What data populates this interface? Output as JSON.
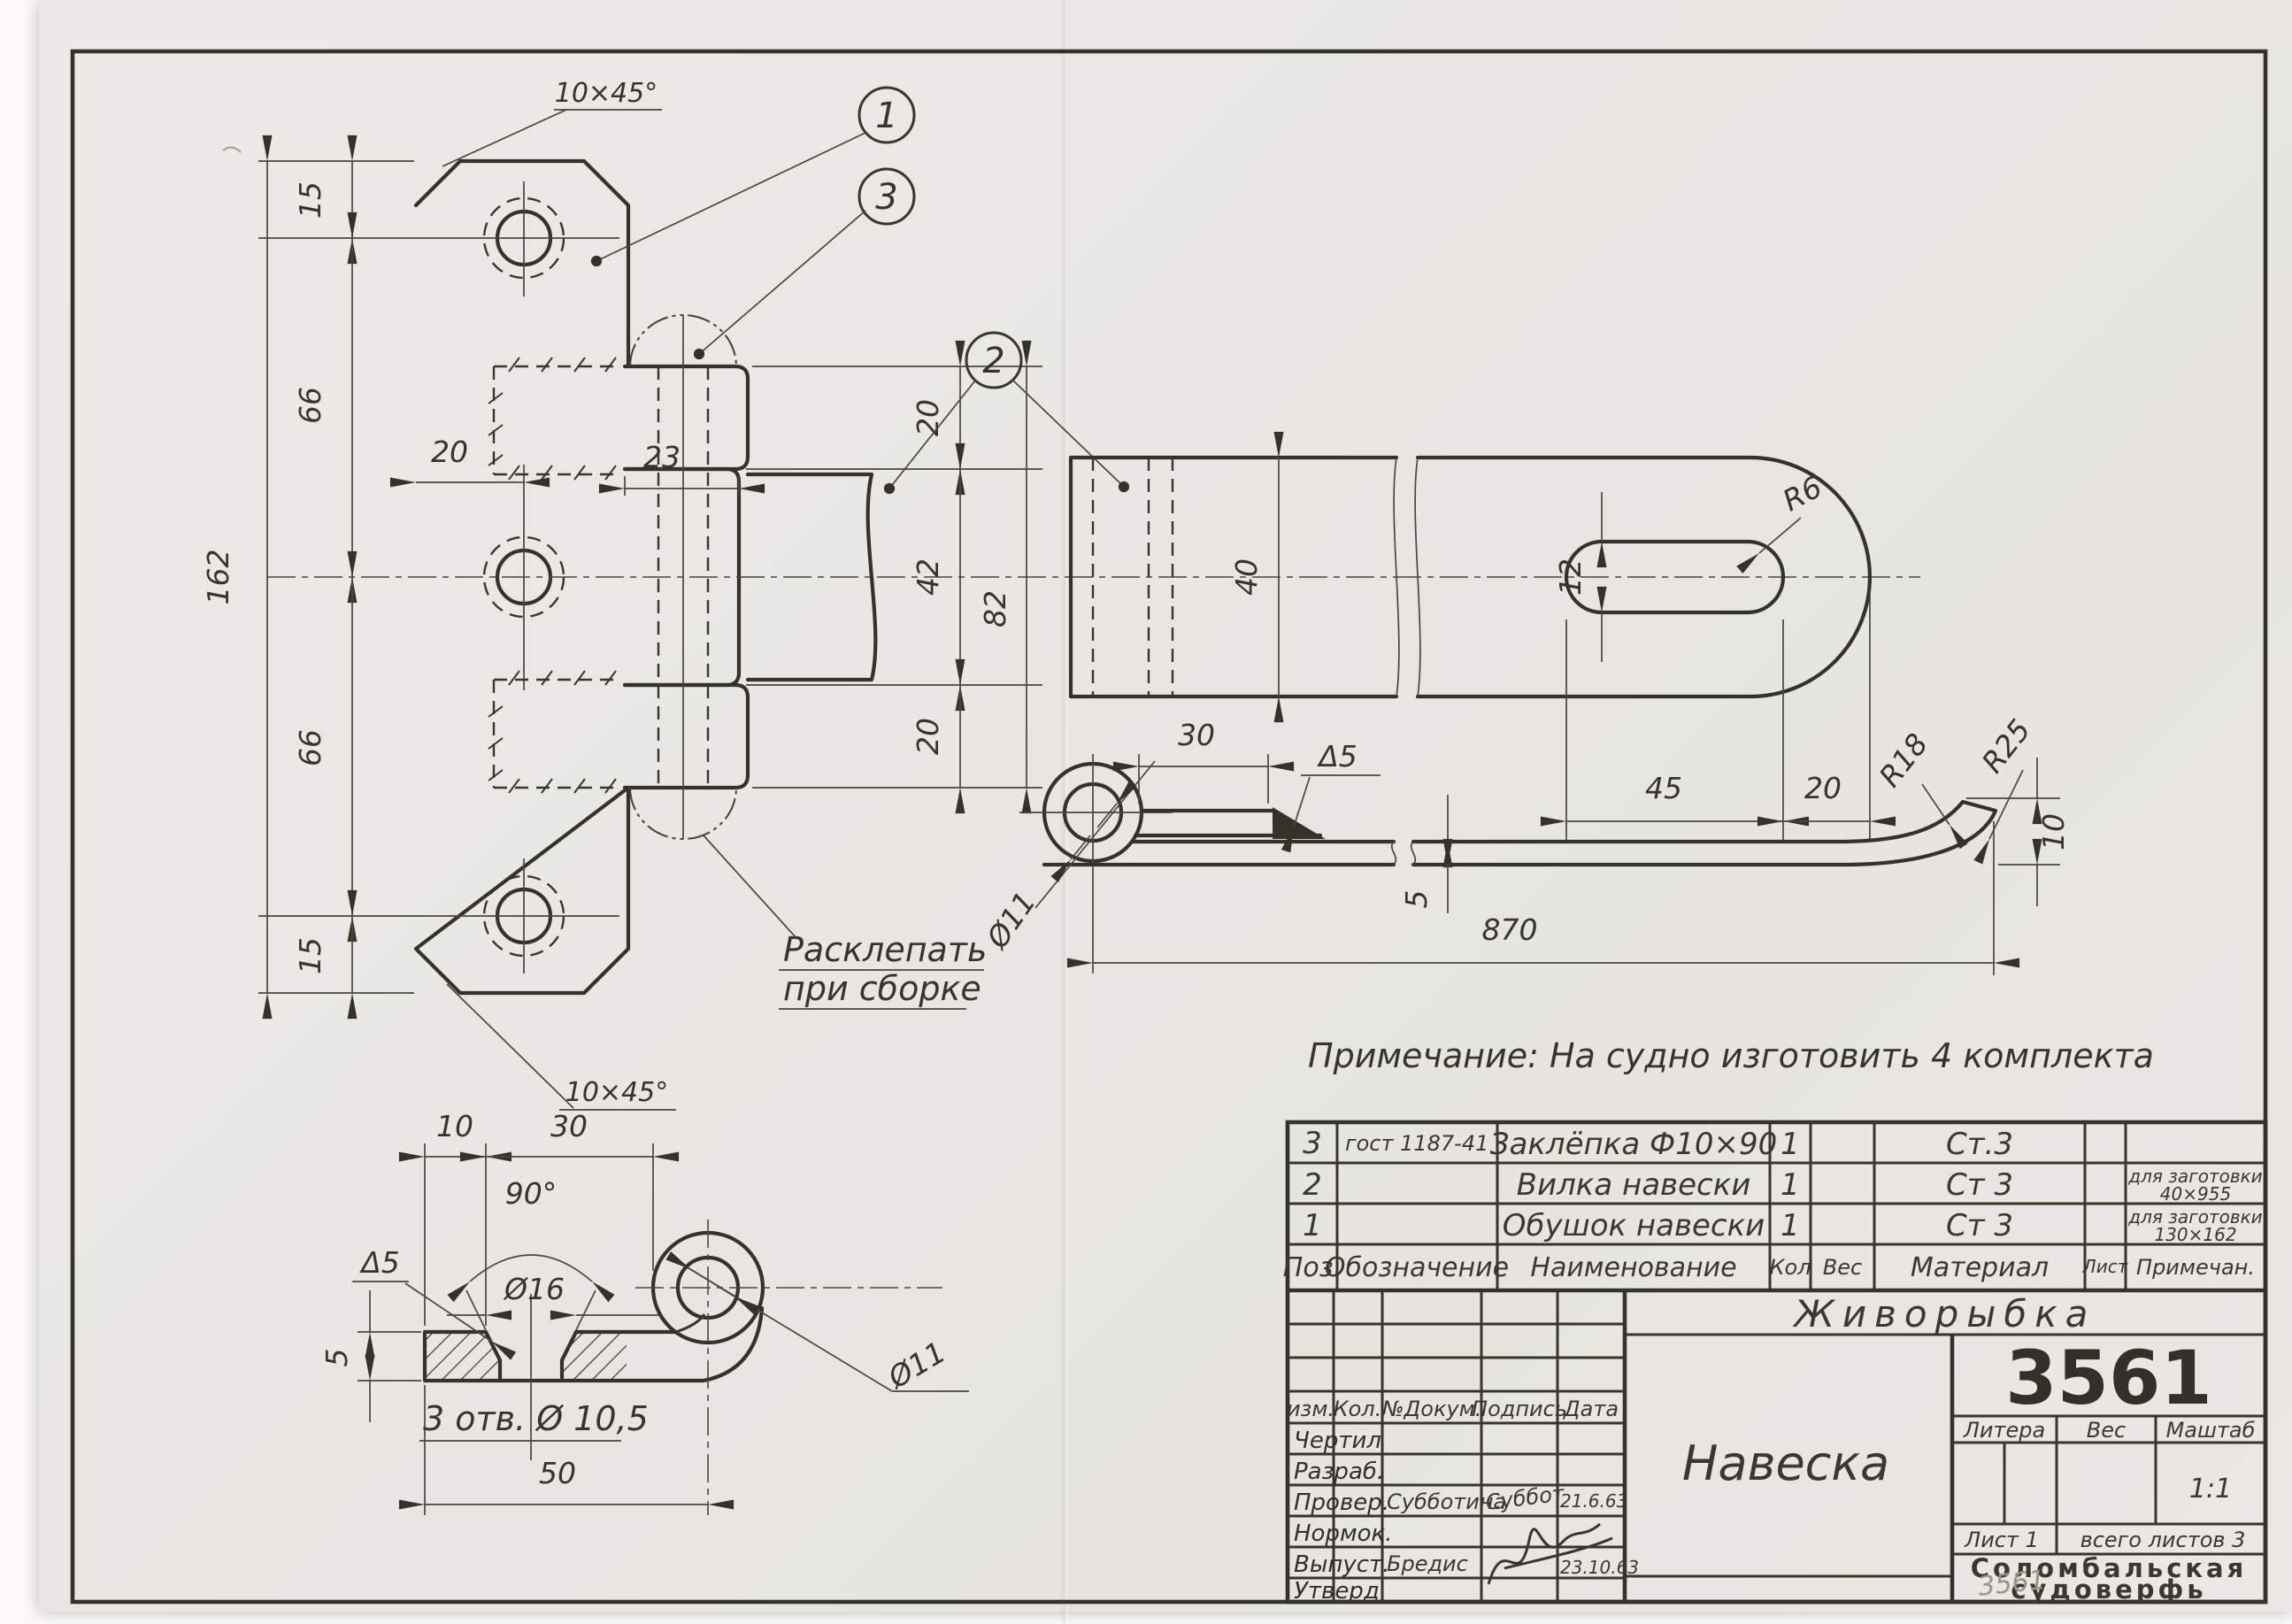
{
  "note": {
    "text": "Примечание:  На судно  изготовить  4 комплекта"
  },
  "front_view": {
    "balloon_1": "1",
    "balloon_2": "2",
    "balloon_3": "3",
    "chamfer_top": "10×45°",
    "chamfer_bottom": "10×45°",
    "dim_total": "162",
    "dim_edge_top": "15",
    "dim_pitch_top": "66",
    "dim_pitch_bottom": "66",
    "dim_edge_bottom": "15",
    "dim_hole_offset": "20",
    "dim_knuckle_w": "23",
    "dim_k_top": "20",
    "dim_gap": "42",
    "dim_span": "82",
    "dim_k_bottom": "20",
    "rivet_note_1": "Расклепать",
    "rivet_note_2": "при сборке"
  },
  "strap_view": {
    "dim_width": "40",
    "dim_slot_w": "12",
    "dim_slot_len": "45",
    "dim_end": "20",
    "radius_slot": "R6"
  },
  "hook_view": {
    "dim_straight": "30",
    "weld": "Δ5",
    "dim_thick": "5",
    "dim_length": "870",
    "dim_tip": "10",
    "radius_inner": "R18",
    "radius_outer": "R25",
    "dia_eye": "Ø11"
  },
  "section_view": {
    "dim_a": "10",
    "dim_b": "30",
    "angle": "90°",
    "dia_csk": "Ø16",
    "weld": "Δ5",
    "dim_thick": "5",
    "holes_note": "3 отв. Ø 10,5",
    "dim_len": "50",
    "dia_eye": "Ø11"
  },
  "parts_table": {
    "headers": {
      "pos": "Поз.",
      "designation": "Обозначение",
      "name": "Наименование",
      "qty": "Кол",
      "weight": "Вес",
      "material": "Материал",
      "sheet": "Лист",
      "note": "Примечан."
    },
    "rows": [
      {
        "pos": "3",
        "designation": "гост 1187-41",
        "name": "Заклёпка Ф10×90",
        "qty": "1",
        "weight": "",
        "material": "Ст.3",
        "sheet": "",
        "note_1": "",
        "note_2": ""
      },
      {
        "pos": "2",
        "designation": "",
        "name": "Вилка навески",
        "qty": "1",
        "weight": "",
        "material": "Ст 3",
        "sheet": "",
        "note_1": "для заготовки",
        "note_2": "40×955"
      },
      {
        "pos": "1",
        "designation": "",
        "name": "Обушок навески",
        "qty": "1",
        "weight": "",
        "material": "Ст 3",
        "sheet": "",
        "note_1": "для заготовки",
        "note_2": "130×162"
      }
    ]
  },
  "title_block": {
    "project": "Живорыбка",
    "doc_number": "3561",
    "title": "Навеска",
    "litera_label": "Литера",
    "weight_label": "Вес",
    "scale_label": "Маштаб",
    "scale_value": "1:1",
    "sheet_label": "Лист 1",
    "sheets_total": "всего листов 3",
    "company_1": "Соломбальская",
    "company_2": "судоверфь",
    "pencil_note": "3561",
    "sig_headers": {
      "izm": "изм.",
      "kol": "Кол.",
      "doc": "№Докум.",
      "sign": "Подпись",
      "date": "Дата"
    },
    "sig_rows": [
      {
        "label": "Чертил",
        "name": "",
        "sign": "",
        "date": ""
      },
      {
        "label": "Разраб.",
        "name": "",
        "sign": "",
        "date": ""
      },
      {
        "label": "Провер.",
        "name": "Субботина",
        "sign": "Суббот",
        "date": "21.6.63"
      },
      {
        "label": "Нормок.",
        "name": "",
        "sign": "",
        "date": ""
      },
      {
        "label": "Выпуст.",
        "name": "Бредис",
        "sign": "",
        "date": "23.10.63"
      },
      {
        "label": "Утверд.",
        "name": "",
        "sign": "",
        "date": ""
      }
    ]
  }
}
